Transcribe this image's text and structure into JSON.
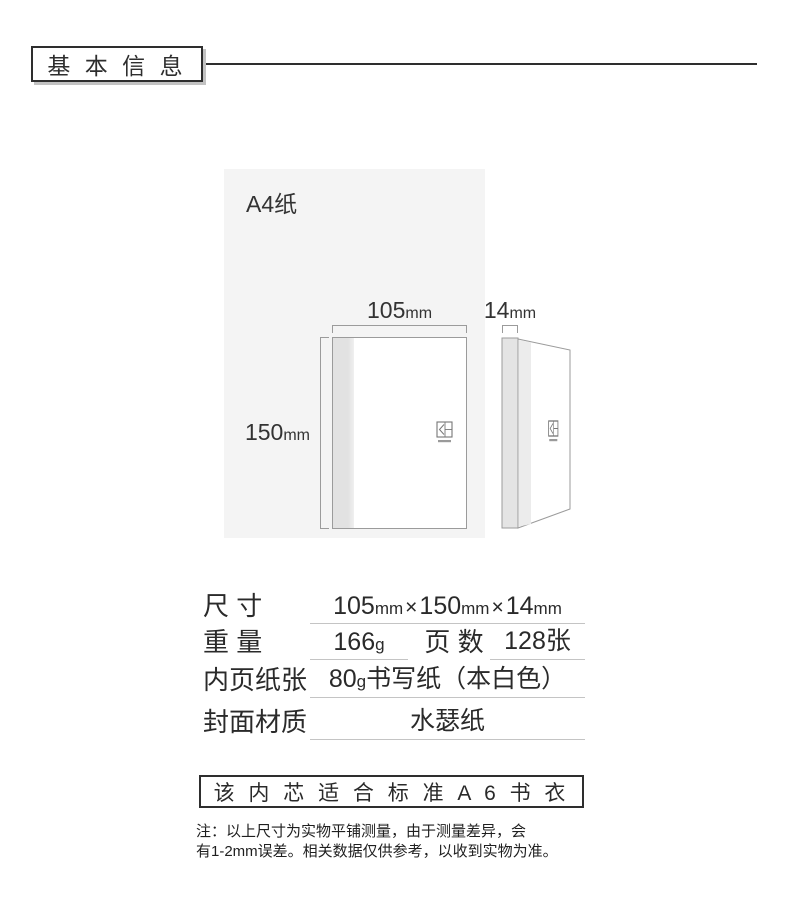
{
  "header": {
    "title": "基 本 信 息"
  },
  "diagram": {
    "a4_label": "A4纸",
    "front_view": {
      "width_num": "105",
      "width_unit": "mm",
      "height_num": "150",
      "height_unit": "mm"
    },
    "side_view": {
      "depth_num": "14",
      "depth_unit": "mm"
    }
  },
  "specs": {
    "size": {
      "label": "尺 寸",
      "n1": "105",
      "u1": "mm",
      "x1": "×",
      "n2": "150",
      "u2": "mm",
      "x2": "×",
      "n3": "14",
      "u3": "mm"
    },
    "weight": {
      "label": "重 量",
      "num": "166",
      "unit": "g"
    },
    "pages": {
      "label": "页 数",
      "value": "128张"
    },
    "paper": {
      "label": "内页纸张",
      "num": "80",
      "unit": "g",
      "rest": "书写纸（本白色）"
    },
    "cover": {
      "label": "封面材质",
      "value": "水瑟纸"
    }
  },
  "fit_box": {
    "text": "该 内 芯 适 合 标 准 A 6 书 衣"
  },
  "footnote": {
    "line1": "注：以上尺寸为实物平铺测量，由于测量差异，会",
    "line2": "有1-2mm误差。相关数据仅供参考，以收到实物为准。"
  },
  "colors": {
    "accent_border": "#2e2e2e",
    "a4_paper_bg": "#f4f4f4",
    "diagram_line": "#9b9b9b",
    "underline": "#c4c4c4"
  }
}
